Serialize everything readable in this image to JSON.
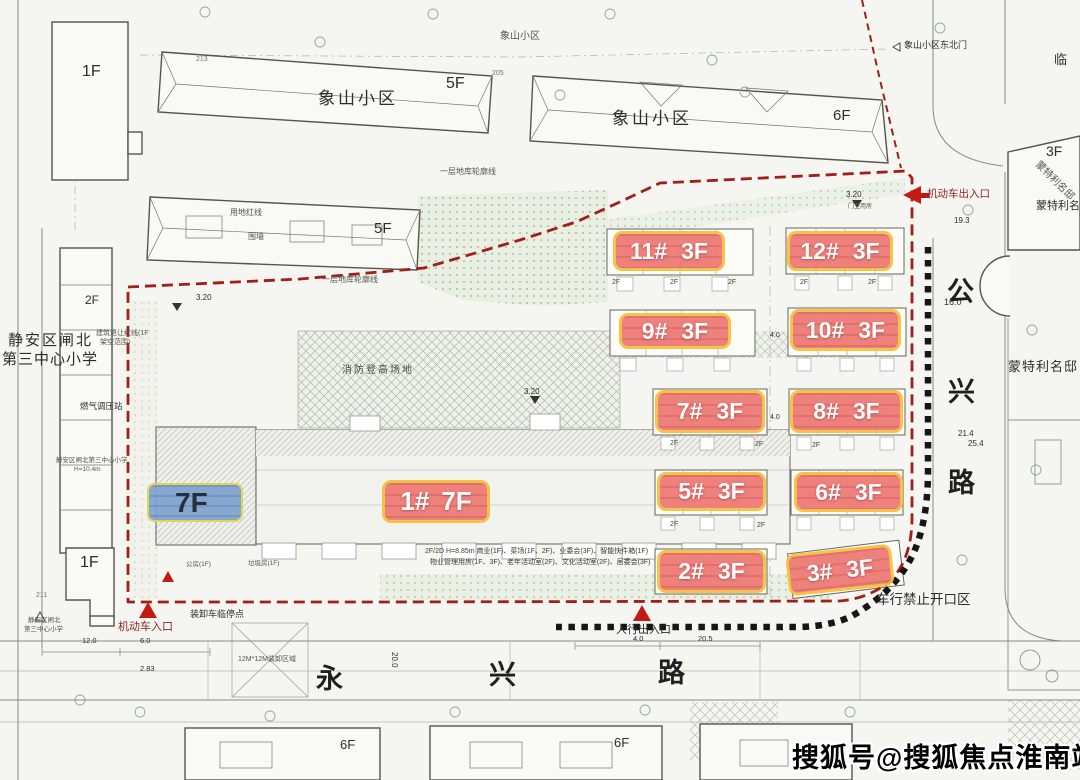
{
  "meta": {
    "description": "residential compound site plan with numbered building labels"
  },
  "colors": {
    "label_pink": "#ef7b76",
    "label_border_yellow": "#f5c13e",
    "label_blue": "#7fa3cf",
    "boundary_red": "#a21f17",
    "no_opening_black": "#161616",
    "arrow_red": "#c11b14",
    "landscape_green": "#b3c8a8"
  },
  "building_labels": [
    {
      "num": "11#",
      "floors": "3F"
    },
    {
      "num": "12#",
      "floors": "3F"
    },
    {
      "num": "9#",
      "floors": "3F"
    },
    {
      "num": "10#",
      "floors": "3F"
    },
    {
      "num": "7#",
      "floors": "3F"
    },
    {
      "num": "8#",
      "floors": "3F"
    },
    {
      "num": "5#",
      "floors": "3F"
    },
    {
      "num": "6#",
      "floors": "3F"
    },
    {
      "num": "2#",
      "floors": "3F"
    },
    {
      "num": "3#",
      "floors": "3F"
    },
    {
      "num": "1#",
      "floors": "7F"
    }
  ],
  "tower_label": {
    "floors": "7F"
  },
  "roads": {
    "gongxing": {
      "name": "公兴路",
      "chars": [
        "公",
        "兴",
        "路"
      ]
    },
    "yongxing": {
      "name": "永兴路",
      "chars": [
        "永",
        "兴",
        "路"
      ]
    }
  },
  "watermark": {
    "text": "搜狐号@搜狐焦点淮南站"
  },
  "minor": {
    "f2": "2F"
  },
  "annotations": [
    {
      "text": "象山小区"
    },
    {
      "text": "5F"
    },
    {
      "text": "象山小区"
    },
    {
      "text": "6F"
    },
    {
      "text": "象山小区东北门"
    },
    {
      "text": "机动车出入口"
    },
    {
      "text": "临"
    },
    {
      "text": "3F"
    },
    {
      "text": "蒙特利名邸"
    },
    {
      "text": "蒙特利名邸"
    },
    {
      "text": "蒙特利名邸"
    },
    {
      "text": "5F"
    },
    {
      "text": "用地红线"
    },
    {
      "text": "围墙"
    },
    {
      "text": "一层地库轮廓线"
    },
    {
      "text": "一层地库轮廓线"
    },
    {
      "text": "静安区闸北"
    },
    {
      "text": "第三中心小学"
    },
    {
      "text": "2F"
    },
    {
      "text": "建筑退让红线(1F"
    },
    {
      "text": "架空范围)"
    },
    {
      "text": "燃气调压站"
    },
    {
      "text": "静安区闸北第三中心小学"
    },
    {
      "text": "H=10.4m"
    },
    {
      "text": "消防登高场地"
    },
    {
      "text": "3.20"
    },
    {
      "text": "3.20"
    },
    {
      "text": "3.20"
    },
    {
      "text": "门卫用房"
    },
    {
      "text": "1F"
    },
    {
      "text": "1F"
    },
    {
      "text": "机动车入口"
    },
    {
      "text": "装卸车临停点"
    },
    {
      "text": "人行出入口"
    },
    {
      "text": "车行禁止开口区"
    },
    {
      "text": "12M*12M装卸区域"
    },
    {
      "text": "6F"
    },
    {
      "text": "6F"
    },
    {
      "text": "2F/2D H=8.85m 商业(1F)、菜场(1F、2F)、业委会(3F)、智能快件箱(1F)"
    },
    {
      "text": "物业管理用房(1F、3F)、老年活动室(2F)、文化活动室(2F)、居委会(3F)"
    },
    {
      "text": "公房(1F)"
    },
    {
      "text": "垃圾房(1F)"
    },
    {
      "text": "213"
    },
    {
      "text": "205"
    },
    {
      "text": "211"
    },
    {
      "text": "16.0"
    },
    {
      "text": "19.3"
    },
    {
      "text": "21.4"
    },
    {
      "text": "25.4"
    },
    {
      "text": "12.0"
    },
    {
      "text": "6.0"
    },
    {
      "text": "2.83"
    },
    {
      "text": "4.0"
    },
    {
      "text": "20.5"
    },
    {
      "text": "20.0"
    },
    {
      "text": "4.0"
    },
    {
      "text": "4.0"
    },
    {
      "text": "象山小区"
    },
    {
      "text": "静安区闸北"
    },
    {
      "text": "第三中心小学"
    }
  ]
}
